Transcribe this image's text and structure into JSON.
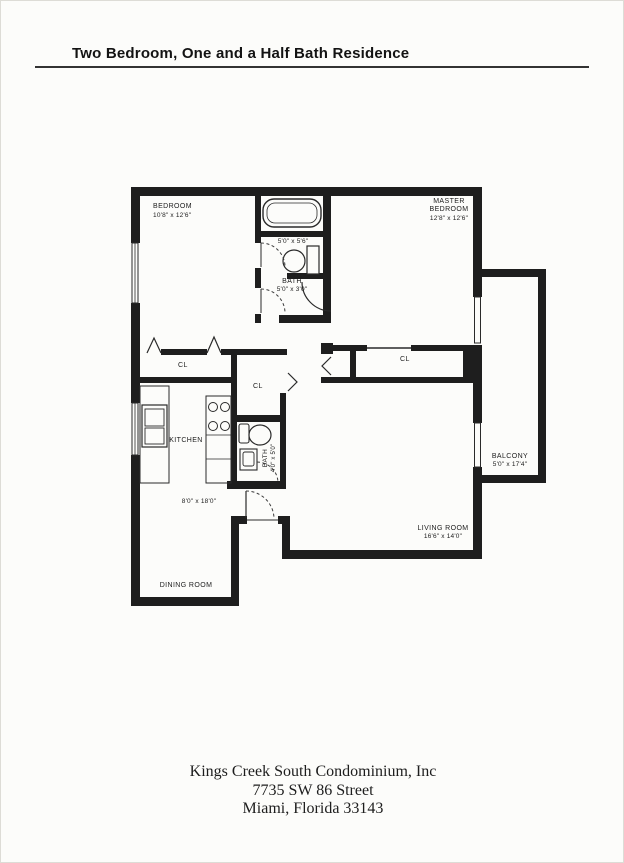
{
  "page": {
    "title": "Two Bedroom, One and a Half Bath Residence",
    "footer_line1": "Kings Creek South Condominium, Inc",
    "footer_line2": "7735 SW 86 Street",
    "footer_line3": "Miami, Florida 33143"
  },
  "rooms": {
    "bedroom": {
      "name": "BEDROOM",
      "dims": "10'8\" x 12'6\""
    },
    "master_bedroom": {
      "name_line1": "MASTER",
      "name_line2": "BEDROOM",
      "dims": "12'8\" x 12'6\""
    },
    "bath_vanity": {
      "dims": "5'0\" x 5'6\""
    },
    "main_bath": {
      "name": "BATH",
      "dims": "5'0\" x 3'0\""
    },
    "half_bath": {
      "name": "BATH",
      "dims": "4'0\" x 5'0\""
    },
    "kitchen": {
      "name": "KITCHEN"
    },
    "dining_room": {
      "name": "DINING ROOM",
      "dims": "8'0\" x 18'0\""
    },
    "living_room": {
      "name": "LIVING ROOM",
      "dims": "16'6\" x 14'0\""
    },
    "balcony": {
      "name": "BALCONY",
      "dims": "5'0\" x 17'4\""
    },
    "closet_bedroom": {
      "name": "CL"
    },
    "closet_hall": {
      "name": "CL"
    },
    "closet_master": {
      "name": "CL"
    }
  },
  "colors": {
    "wall": "#1e1e1e",
    "paper": "#fcfcfa",
    "line": "#2a2a2a"
  }
}
